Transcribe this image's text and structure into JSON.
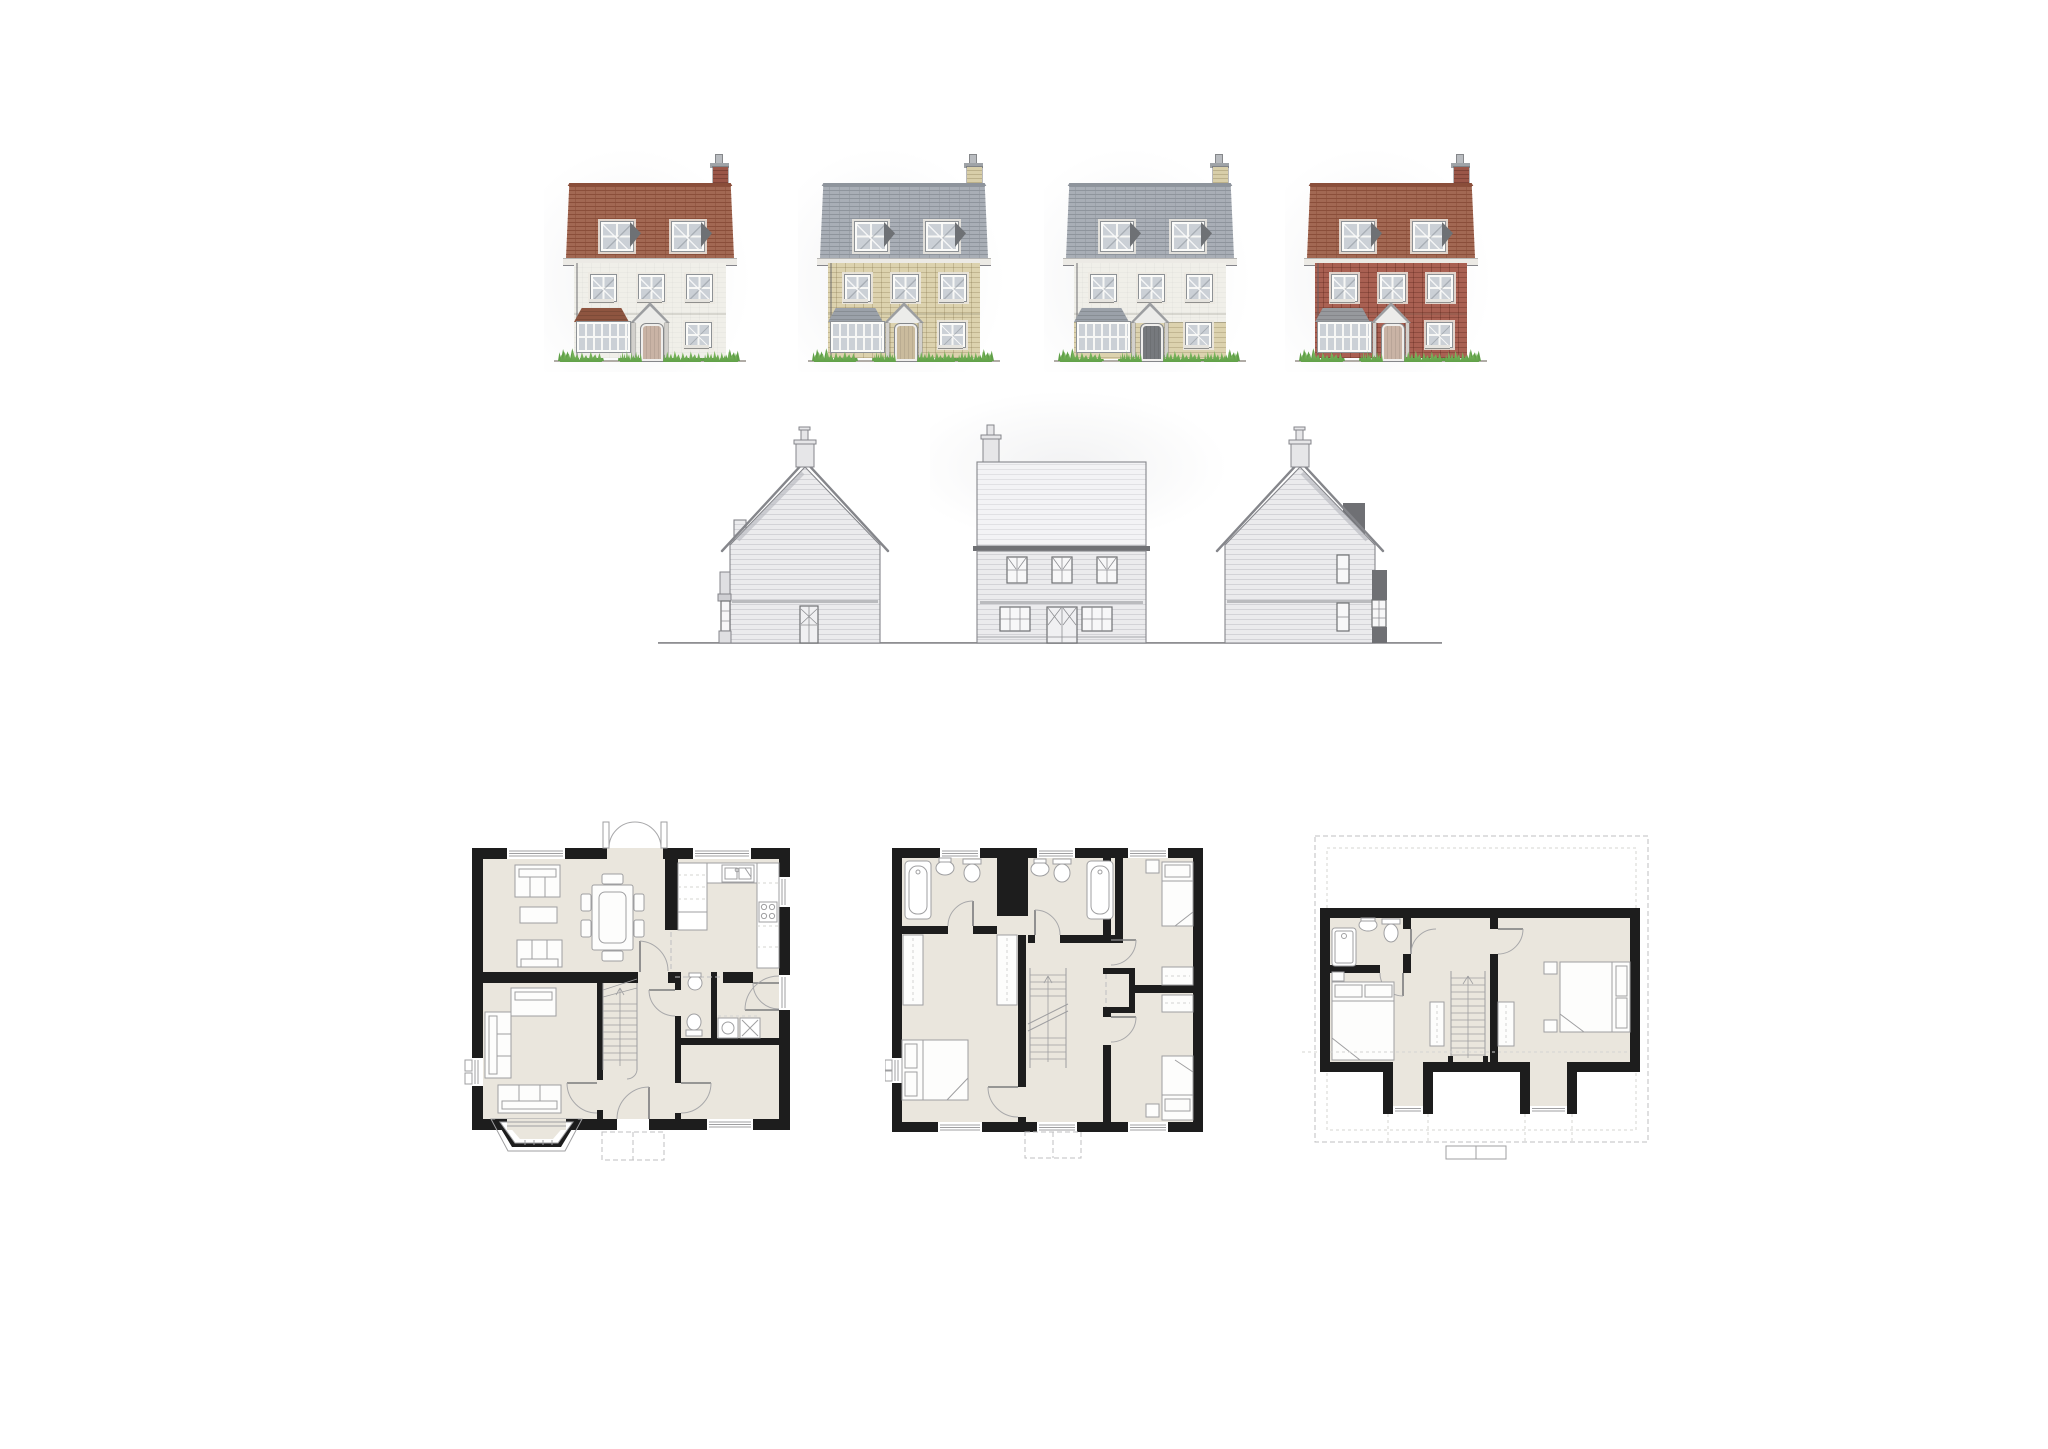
{
  "sheet": {
    "background": "#ffffff",
    "aria": "architectural-house-type-drawing-sheet"
  },
  "front_elevations": {
    "aria": "front-elevation-material-options",
    "shared": {
      "glass": "#cbd0d6",
      "frame": "#fbfbf9",
      "frame_edge": "#8d9195",
      "sill": "#e6e4df",
      "fascia": "#eceae5",
      "fascia_edge": "#85858a",
      "porch_dark": "#9c9ea1",
      "porch_light": "#ececea",
      "post": "#d2d0cc",
      "shade": "#6e7175",
      "grass1": "#8cc56b",
      "grass2": "#60a048",
      "ground": "#a29e97",
      "flash": "#9aa0a6",
      "pot": "#b9bcc0"
    },
    "houses": [
      {
        "id": "house-1-white-render-red-tile",
        "x": 566,
        "roof": "#9d604a",
        "roof_line": "#8a4e3a",
        "wall": "#f0efe9",
        "wall_line": "rgba(0,0,0,0.025)",
        "chimney": "#9a5648",
        "chimney_line": "rgba(70,30,20,0.35)",
        "bay_roof": "#8e5540",
        "door": "#c9b3a5",
        "plinth": ""
      },
      {
        "id": "house-2-buff-stone-slate",
        "x": 820,
        "roof": "#a4aab2",
        "roof_line": "#8e949c",
        "wall": "#dcd2ae",
        "wall_line": "rgba(125,110,70,0.28)",
        "chimney": "#d8cea9",
        "chimney_line": "rgba(125,110,70,0.3)",
        "bay_roof": "#9ba1a9",
        "door": "#cabb9d",
        "plinth": ""
      },
      {
        "id": "house-3-render-stone-plinth-slate",
        "x": 1066,
        "roof": "#a4aab2",
        "roof_line": "#8e949c",
        "wall": "#f0efe9",
        "wall_line": "rgba(0,0,0,0.025)",
        "chimney": "#d8cea9",
        "chimney_line": "rgba(125,110,70,0.3)",
        "bay_roof": "#9ba1a9",
        "door": "#76797d",
        "plinth": "#dcd2ae"
      },
      {
        "id": "house-4-red-brick-red-tile",
        "x": 1307,
        "roof": "#9d604a",
        "roof_line": "#8a4e3a",
        "wall": "#a96052",
        "wall_line": "rgba(80,30,20,0.3)",
        "chimney": "#9a5648",
        "chimney_line": "rgba(70,30,20,0.35)",
        "bay_roof": "#97999d",
        "door": "#c9b3a5",
        "plinth": ""
      }
    ]
  },
  "line_elevations": {
    "aria": "side-and-rear-elevations",
    "colors": {
      "outline": "#85868b",
      "board_bg": "#ebebed",
      "board_ln": "#d3d3d7",
      "roof_bg": "#f3f3f5",
      "roof_ln": "#e1e1e4",
      "dark": "#6f7074",
      "band": "#9a9b9f",
      "chim": "#e6e6e8",
      "ground": "#8f8f92",
      "glass": "#f7f7f8"
    }
  },
  "floor_plans": {
    "aria": "ground-first-and-second-floor-plans",
    "colors": {
      "wall": "#1d1d1d",
      "floor": "#eae6dd",
      "line": "#9f9fa1",
      "furn": "#fdfdfc",
      "arc": "#a8a8aa",
      "dash": "#bfbfc1",
      "stair": "#f5f4f0"
    },
    "plans": [
      {
        "id": "ground-floor-plan"
      },
      {
        "id": "first-floor-plan"
      },
      {
        "id": "second-floor-plan"
      }
    ]
  }
}
